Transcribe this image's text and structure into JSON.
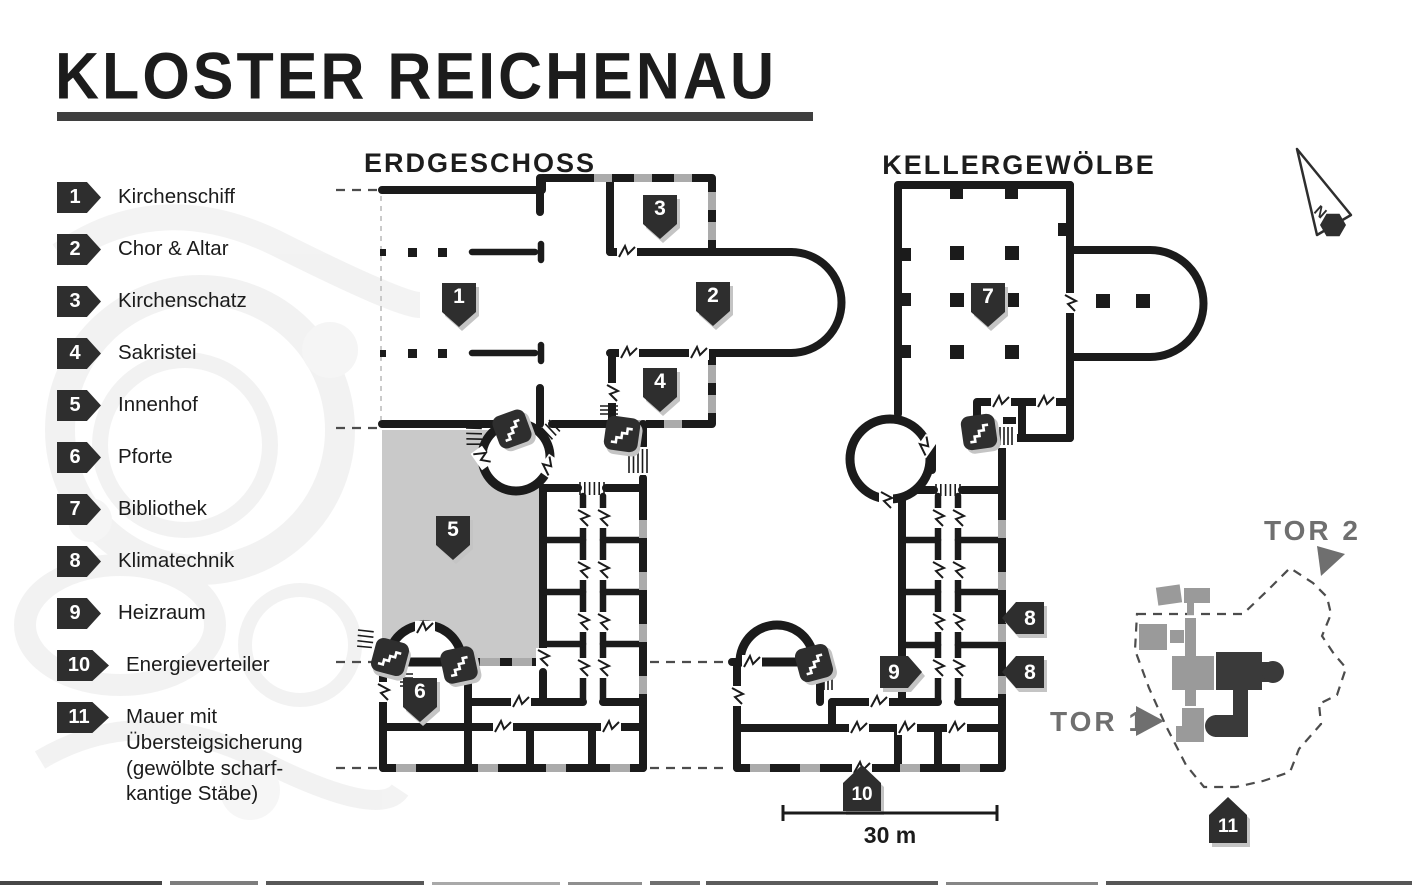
{
  "title": "KLOSTER REICHENAU",
  "floor_labels": {
    "ground": "ERDGESCHOSS",
    "cellar": "KELLERGEWÖLBE"
  },
  "legend": {
    "items": [
      {
        "num": "1",
        "label": "Kirchenschiff"
      },
      {
        "num": "2",
        "label": "Chor & Altar"
      },
      {
        "num": "3",
        "label": "Kirchenschatz"
      },
      {
        "num": "4",
        "label": "Sakristei"
      },
      {
        "num": "5",
        "label": "Innenhof"
      },
      {
        "num": "6",
        "label": "Pforte"
      },
      {
        "num": "7",
        "label": "Bibliothek"
      },
      {
        "num": "8",
        "label": "Klimatechnik"
      },
      {
        "num": "9",
        "label": "Heizraum"
      },
      {
        "num": "10",
        "label": "Energieverteiler"
      },
      {
        "num": "11",
        "label": "Mauer mit Übersteigsicherung (gewölbte scharf-kantige Stäbe)"
      }
    ]
  },
  "map_markers": {
    "m1": "1",
    "m2": "2",
    "m3": "3",
    "m4": "4",
    "m5": "5",
    "m6": "6",
    "m7": "7",
    "m8": "8",
    "m9": "9",
    "m10": "10",
    "m11": "11"
  },
  "minimap": {
    "tor1": "TOR 1",
    "tor2": "TOR 2"
  },
  "scale_bar": {
    "label": "30 m"
  },
  "compass": {
    "label": "N"
  },
  "colors": {
    "wall": "#1b1b1b",
    "courtyard": "#c9c9c9",
    "badge": "#2e2e2e",
    "badge_shadow": "#c4c4c4",
    "window_dash": "#ababab",
    "minimap_gray": "#9a9a9a",
    "minimap_dark": "#3a3a3a",
    "tor_label": "#6f6f6f"
  }
}
